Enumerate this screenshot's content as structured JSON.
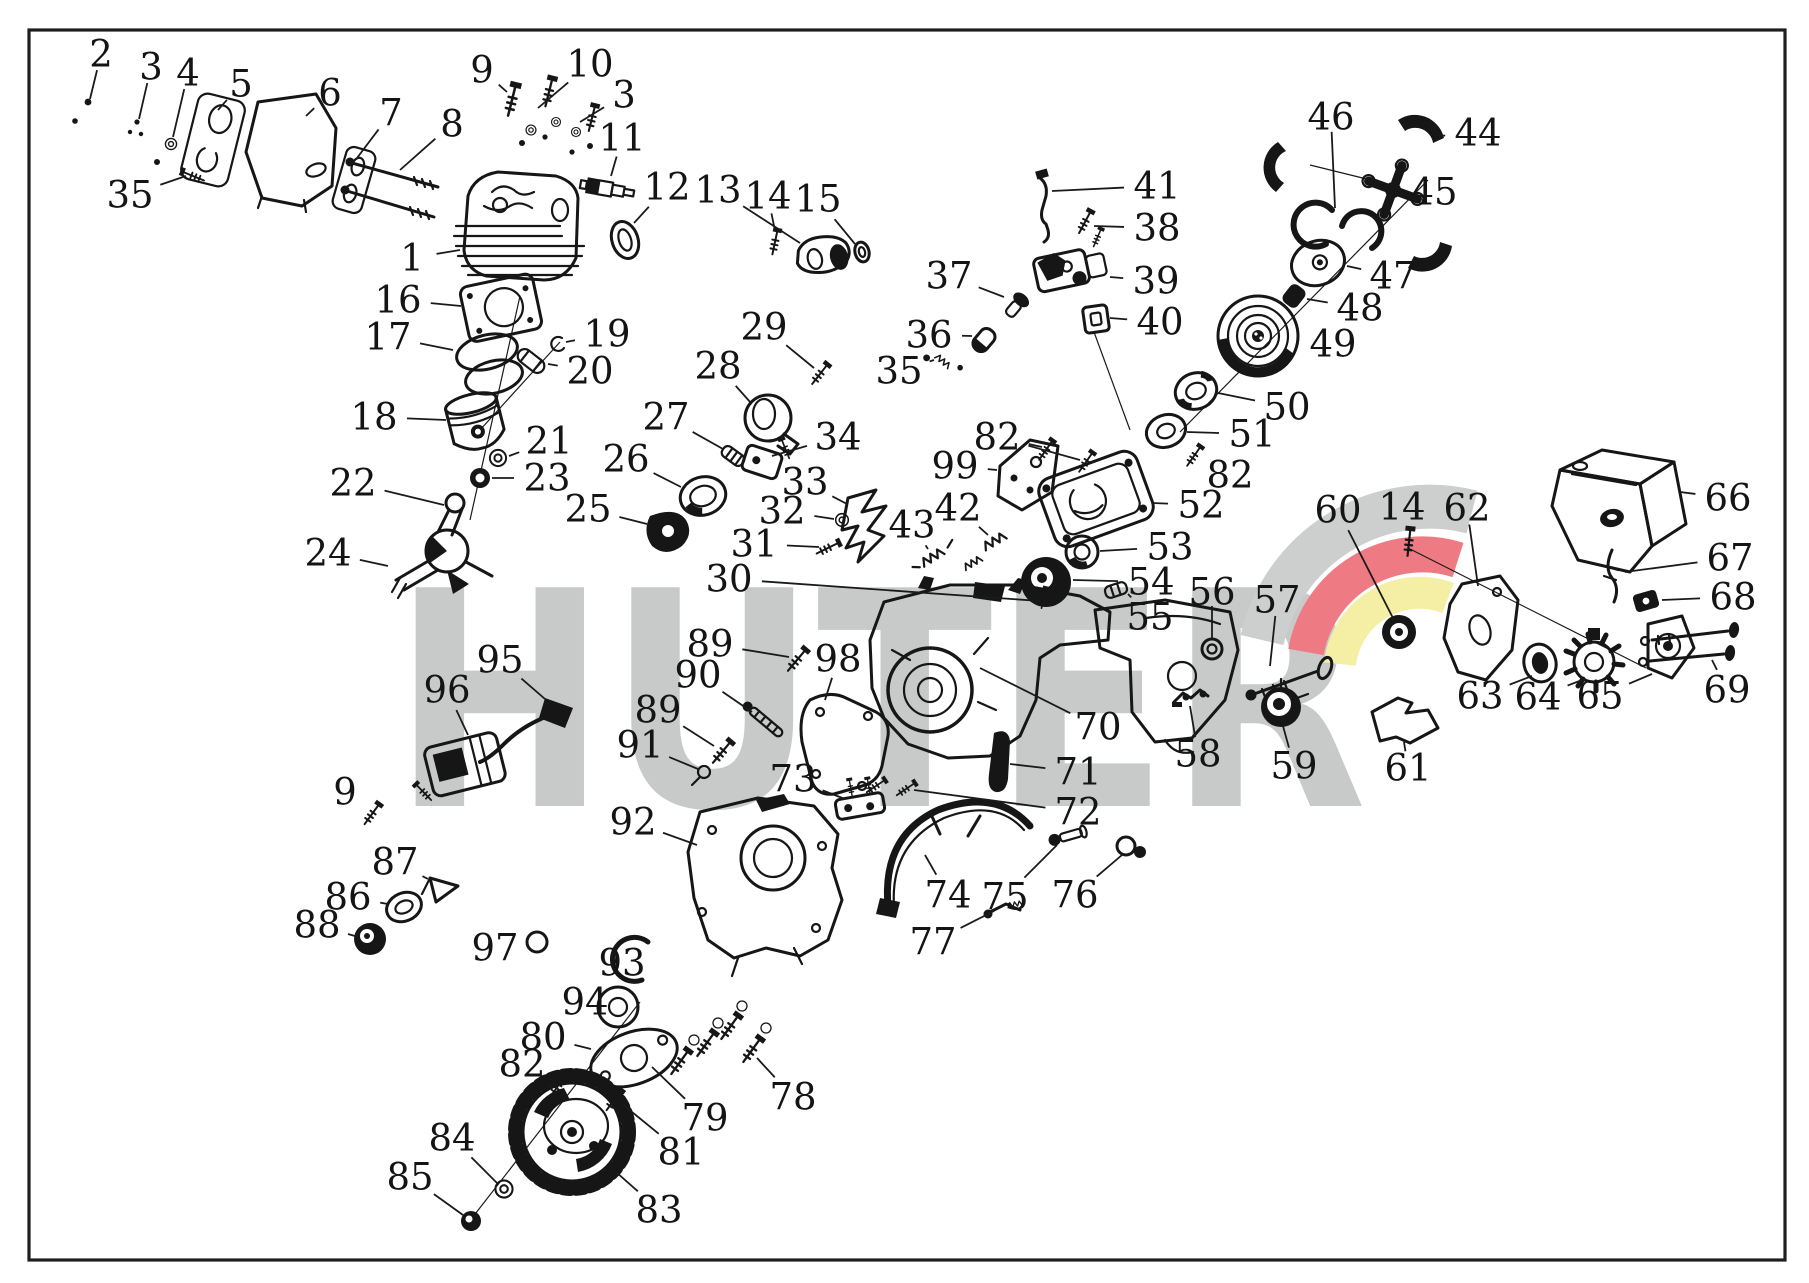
{
  "diagram": {
    "type": "exploded-parts-diagram",
    "subject": "chainsaw engine parts",
    "background": "#ffffff",
    "border_color": "#1e1e1e",
    "line_color": "#161616"
  },
  "watermark": {
    "text": "HUTER",
    "color": "#c8caca",
    "logo_colors": {
      "gray": "#cdcfcf",
      "red": "#ee7b84",
      "yellow": "#f5efa5"
    }
  },
  "label_style": {
    "font_size": 37,
    "color": "#141414",
    "leader_color": "#1a1a1a"
  },
  "labels": [
    {
      "n": "2",
      "x": 101,
      "y": 54,
      "tx": 90,
      "ty": 99
    },
    {
      "n": "3",
      "x": 151,
      "y": 67,
      "tx": 139,
      "ty": 119
    },
    {
      "n": "4",
      "x": 188,
      "y": 73,
      "tx": 173,
      "ty": 137
    },
    {
      "n": "5",
      "x": 241,
      "y": 84,
      "tx": 218,
      "ty": 110
    },
    {
      "n": "6",
      "x": 330,
      "y": 93,
      "tx": 306,
      "ty": 116
    },
    {
      "n": "7",
      "x": 391,
      "y": 113,
      "tx": 357,
      "ty": 158
    },
    {
      "n": "8",
      "x": 452,
      "y": 124,
      "tx": 400,
      "ty": 170
    },
    {
      "n": "9",
      "x": 482,
      "y": 70,
      "tx": 507,
      "ty": 92
    },
    {
      "n": "10",
      "x": 590,
      "y": 64,
      "tx": 538,
      "ty": 108
    },
    {
      "n": "3",
      "x": 624,
      "y": 95,
      "tx": 580,
      "ty": 122
    },
    {
      "n": "11",
      "x": 622,
      "y": 138,
      "tx": 611,
      "ty": 176
    },
    {
      "n": "1",
      "x": 412,
      "y": 258,
      "tx": 460,
      "ty": 250
    },
    {
      "n": "12",
      "x": 667,
      "y": 187,
      "tx": 634,
      "ty": 223
    },
    {
      "n": "13",
      "x": 718,
      "y": 190,
      "tx": 800,
      "ty": 243
    },
    {
      "n": "14",
      "x": 768,
      "y": 196,
      "tx": 775,
      "ty": 231
    },
    {
      "n": "15",
      "x": 818,
      "y": 199,
      "tx": 855,
      "ty": 244
    },
    {
      "n": "35",
      "x": 130,
      "y": 195,
      "tx": 186,
      "ty": 176
    },
    {
      "n": "16",
      "x": 398,
      "y": 300,
      "tx": 461,
      "ty": 306
    },
    {
      "n": "17",
      "x": 388,
      "y": 337,
      "tx": 453,
      "ty": 350
    },
    {
      "n": "19",
      "x": 607,
      "y": 334,
      "tx": 566,
      "ty": 342
    },
    {
      "n": "20",
      "x": 590,
      "y": 371,
      "tx": 548,
      "ty": 364
    },
    {
      "n": "18",
      "x": 374,
      "y": 417,
      "tx": 446,
      "ty": 420
    },
    {
      "n": "21",
      "x": 549,
      "y": 441,
      "tx": 509,
      "ty": 456
    },
    {
      "n": "23",
      "x": 547,
      "y": 478,
      "tx": 492,
      "ty": 478
    },
    {
      "n": "22",
      "x": 353,
      "y": 483,
      "tx": 444,
      "ty": 505
    },
    {
      "n": "24",
      "x": 328,
      "y": 553,
      "tx": 388,
      "ty": 566
    },
    {
      "n": "25",
      "x": 588,
      "y": 509,
      "tx": 647,
      "ty": 524
    },
    {
      "n": "26",
      "x": 626,
      "y": 459,
      "tx": 681,
      "ty": 487
    },
    {
      "n": "27",
      "x": 666,
      "y": 417,
      "tx": 723,
      "ty": 449
    },
    {
      "n": "28",
      "x": 718,
      "y": 366,
      "tx": 751,
      "ty": 403
    },
    {
      "n": "29",
      "x": 764,
      "y": 327,
      "tx": 814,
      "ty": 368
    },
    {
      "n": "34",
      "x": 838,
      "y": 437,
      "tx": 772,
      "ty": 456
    },
    {
      "n": "33",
      "x": 805,
      "y": 482,
      "tx": 847,
      "ty": 504
    },
    {
      "n": "32",
      "x": 782,
      "y": 511,
      "tx": 834,
      "ty": 519
    },
    {
      "n": "31",
      "x": 754,
      "y": 544,
      "tx": 819,
      "ty": 547
    },
    {
      "n": "30",
      "x": 729,
      "y": 579,
      "tx": 1040,
      "ty": 601
    },
    {
      "n": "43",
      "x": 912,
      "y": 525,
      "tx": 928,
      "ty": 549
    },
    {
      "n": "42",
      "x": 958,
      "y": 508,
      "tx": 988,
      "ty": 535
    },
    {
      "n": "37",
      "x": 949,
      "y": 276,
      "tx": 1004,
      "ty": 297
    },
    {
      "n": "36",
      "x": 929,
      "y": 335,
      "tx": 972,
      "ty": 336
    },
    {
      "n": "35",
      "x": 899,
      "y": 371,
      "tx": 934,
      "ty": 360
    },
    {
      "n": "41",
      "x": 1157,
      "y": 186,
      "tx": 1052,
      "ty": 191
    },
    {
      "n": "38",
      "x": 1157,
      "y": 228,
      "tx": 1094,
      "ty": 226
    },
    {
      "n": "39",
      "x": 1156,
      "y": 281,
      "tx": 1110,
      "ty": 277
    },
    {
      "n": "40",
      "x": 1160,
      "y": 322,
      "tx": 1110,
      "ty": 318
    },
    {
      "n": "82",
      "x": 997,
      "y": 437,
      "tx": 1042,
      "ty": 447,
      "tx2": 1080,
      "ty2": 460
    },
    {
      "n": "99",
      "x": 955,
      "y": 466,
      "tx": 997,
      "ty": 470
    },
    {
      "n": "46",
      "x": 1331,
      "y": 117,
      "tx": 1335,
      "ty": 208
    },
    {
      "n": "44",
      "x": 1478,
      "y": 133,
      "tx": 1438,
      "ty": 136
    },
    {
      "n": "45",
      "x": 1434,
      "y": 192,
      "tx": 1412,
      "ty": 190
    },
    {
      "n": "47",
      "x": 1393,
      "y": 276,
      "tx": 1347,
      "ty": 266
    },
    {
      "n": "48",
      "x": 1360,
      "y": 308,
      "tx": 1307,
      "ty": 299
    },
    {
      "n": "49",
      "x": 1333,
      "y": 344,
      "tx": 1300,
      "ty": 338
    },
    {
      "n": "50",
      "x": 1287,
      "y": 407,
      "tx": 1218,
      "ty": 393
    },
    {
      "n": "51",
      "x": 1252,
      "y": 434,
      "tx": 1187,
      "ty": 432
    },
    {
      "n": "82",
      "x": 1230,
      "y": 475,
      "tx": 1204,
      "ty": 459
    },
    {
      "n": "52",
      "x": 1201,
      "y": 505,
      "tx": 1152,
      "ty": 503
    },
    {
      "n": "53",
      "x": 1170,
      "y": 547,
      "tx": 1100,
      "ty": 551
    },
    {
      "n": "54",
      "x": 1151,
      "y": 582,
      "tx": 1073,
      "ty": 580
    },
    {
      "n": "55",
      "x": 1150,
      "y": 617,
      "tx": 1128,
      "ty": 594
    },
    {
      "n": "56",
      "x": 1212,
      "y": 592,
      "tx": 1212,
      "ty": 638
    },
    {
      "n": "57",
      "x": 1277,
      "y": 600,
      "tx": 1270,
      "ty": 666
    },
    {
      "n": "60",
      "x": 1338,
      "y": 510,
      "tx": 1394,
      "ty": 620
    },
    {
      "n": "14",
      "x": 1402,
      "y": 507,
      "tx": 1408,
      "ty": 528
    },
    {
      "n": "62",
      "x": 1467,
      "y": 508,
      "tx": 1478,
      "ty": 586
    },
    {
      "n": "66",
      "x": 1728,
      "y": 498,
      "tx": 1680,
      "ty": 492
    },
    {
      "n": "67",
      "x": 1730,
      "y": 558,
      "tx": 1625,
      "ty": 572
    },
    {
      "n": "68",
      "x": 1733,
      "y": 597,
      "tx": 1662,
      "ty": 600
    },
    {
      "n": "69",
      "x": 1727,
      "y": 690,
      "tx": 1712,
      "ty": 660
    },
    {
      "n": "63",
      "x": 1480,
      "y": 696,
      "tx": 1532,
      "ty": 676
    },
    {
      "n": "64",
      "x": 1538,
      "y": 697,
      "tx": 1582,
      "ty": 680
    },
    {
      "n": "65",
      "x": 1600,
      "y": 696,
      "tx": 1652,
      "ty": 674
    },
    {
      "n": "61",
      "x": 1408,
      "y": 768,
      "tx": 1404,
      "ty": 742
    },
    {
      "n": "59",
      "x": 1294,
      "y": 766,
      "tx": 1283,
      "ty": 726
    },
    {
      "n": "58",
      "x": 1198,
      "y": 754,
      "tx": 1190,
      "ty": 706
    },
    {
      "n": "70",
      "x": 1098,
      "y": 727,
      "tx": 980,
      "ty": 668
    },
    {
      "n": "71",
      "x": 1078,
      "y": 772,
      "tx": 1010,
      "ty": 764
    },
    {
      "n": "72",
      "x": 1078,
      "y": 812,
      "tx": 914,
      "ty": 790
    },
    {
      "n": "73",
      "x": 793,
      "y": 779,
      "tx": 845,
      "ty": 799
    },
    {
      "n": "89",
      "x": 710,
      "y": 644,
      "tx": 789,
      "ty": 657
    },
    {
      "n": "98",
      "x": 838,
      "y": 659,
      "tx": 825,
      "ty": 700
    },
    {
      "n": "90",
      "x": 698,
      "y": 675,
      "tx": 752,
      "ty": 712
    },
    {
      "n": "89",
      "x": 658,
      "y": 710,
      "tx": 714,
      "ty": 746
    },
    {
      "n": "91",
      "x": 640,
      "y": 745,
      "tx": 698,
      "ty": 769
    },
    {
      "n": "95",
      "x": 500,
      "y": 660,
      "tx": 545,
      "ty": 699
    },
    {
      "n": "96",
      "x": 447,
      "y": 690,
      "tx": 468,
      "ty": 735
    },
    {
      "n": "9",
      "x": 345,
      "y": 792,
      "tx": 365,
      "ty": 808
    },
    {
      "n": "92",
      "x": 633,
      "y": 822,
      "tx": 697,
      "ty": 845
    },
    {
      "n": "87",
      "x": 395,
      "y": 862,
      "tx": 428,
      "ty": 879
    },
    {
      "n": "86",
      "x": 348,
      "y": 897,
      "tx": 388,
      "ty": 904
    },
    {
      "n": "88",
      "x": 317,
      "y": 925,
      "tx": 355,
      "ty": 936
    },
    {
      "n": "97",
      "x": 495,
      "y": 948,
      "tx": 527,
      "ty": 942
    },
    {
      "n": "93",
      "x": 622,
      "y": 963,
      "tx": 641,
      "ty": 953
    },
    {
      "n": "94",
      "x": 585,
      "y": 1002,
      "tx": 599,
      "ty": 1005
    },
    {
      "n": "80",
      "x": 543,
      "y": 1037,
      "tx": 591,
      "ty": 1049
    },
    {
      "n": "82",
      "x": 522,
      "y": 1064,
      "tx": 553,
      "ty": 1080
    },
    {
      "n": "78",
      "x": 793,
      "y": 1097,
      "tx": 757,
      "ty": 1058
    },
    {
      "n": "79",
      "x": 705,
      "y": 1118,
      "tx": 652,
      "ty": 1067
    },
    {
      "n": "81",
      "x": 681,
      "y": 1152,
      "tx": 621,
      "ty": 1103
    },
    {
      "n": "84",
      "x": 452,
      "y": 1138,
      "tx": 497,
      "ty": 1183
    },
    {
      "n": "85",
      "x": 410,
      "y": 1177,
      "tx": 463,
      "ty": 1215
    },
    {
      "n": "83",
      "x": 659,
      "y": 1210,
      "tx": 616,
      "ty": 1172
    },
    {
      "n": "74",
      "x": 948,
      "y": 895,
      "tx": 925,
      "ty": 855
    },
    {
      "n": "75",
      "x": 1005,
      "y": 897,
      "tx": 1057,
      "ty": 845
    },
    {
      "n": "76",
      "x": 1075,
      "y": 895,
      "tx": 1122,
      "ty": 855
    },
    {
      "n": "77",
      "x": 933,
      "y": 942,
      "tx": 994,
      "ty": 911
    }
  ]
}
